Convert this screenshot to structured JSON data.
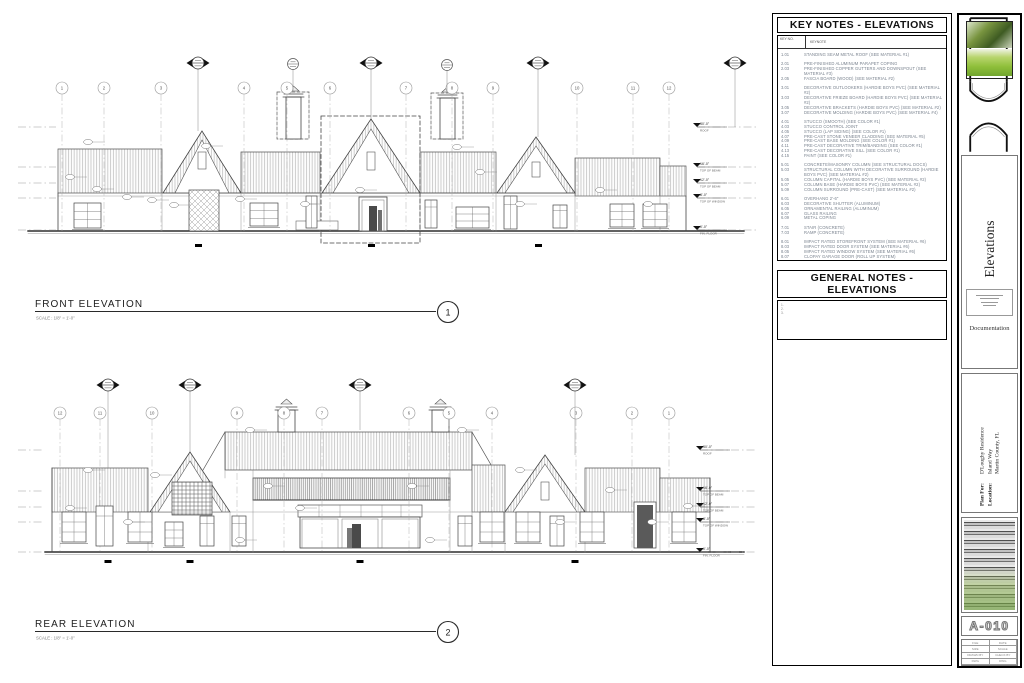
{
  "sheet": {
    "front": {
      "title": "FRONT ELEVATION",
      "number": "1",
      "scale": "SCALE :  1/8\" = 1'-0\""
    },
    "rear": {
      "title": "REAR ELEVATION",
      "number": "2",
      "scale": "SCALE :  1/8\" = 1'-0\""
    },
    "front_grid_labels": [
      "1",
      "2",
      "3",
      "4",
      "5",
      "6",
      "7",
      "8",
      "9",
      "10",
      "11",
      "12"
    ],
    "rear_grid_labels": [
      "12",
      "11",
      "10",
      "9",
      "8",
      "7",
      "6",
      "5",
      "4",
      "3",
      "2",
      "1"
    ],
    "levels": [
      {
        "value": "30'-0\"",
        "label": "ROOF"
      },
      {
        "value": "16'-0\"",
        "label": "TOP OF BEAM"
      },
      {
        "value": "12'-0\"",
        "label": "TOP OF BEAM"
      },
      {
        "value": "8'-0\"",
        "label": "TOP OF WINDOW"
      },
      {
        "value": "0'-0\"",
        "label": "FIN. FLOOR"
      }
    ]
  },
  "key_notes": {
    "title": "KEY NOTES - ELEVATIONS",
    "col_key": "KEY NO.",
    "col_note": "KEYNOTE",
    "items": [
      {
        "no": "1.01",
        "text": "STANDING SEAM METAL ROOF (SEE MATERIAL #1)"
      },
      {
        "no": "2.01",
        "text": "PRE-FINISHED ALUMINUM PARAPET COPING"
      },
      {
        "no": "2.03",
        "text": "PRE-FINISHED COPPER GUTTERS AND DOWNSPOUT (SEE MATERIAL #3)"
      },
      {
        "no": "2.05",
        "text": "FASCIA BOARD (WOOD) (SEE MATERIAL #2)"
      },
      {
        "no": "3.01",
        "text": "DECORATIVE OUTLOOKERS (HARDIE BOYS PVC) (SEE MATERIAL #2)"
      },
      {
        "no": "3.03",
        "text": "DECORATIVE FRIEZE BOARD (HARDIE BOYS PVC) (SEE MATERIAL #2)"
      },
      {
        "no": "3.05",
        "text": "DECORATIVE BRACKETS (HARDIE BOYS PVC) (SEE MATERIAL #2)"
      },
      {
        "no": "3.07",
        "text": "DECORATIVE MOLDING (HARDIE BOYS PVC) (SEE MATERIAL #4)"
      },
      {
        "no": "4.01",
        "text": "STUCCO (SMOOTH) (SEE COLOR #1)"
      },
      {
        "no": "4.03",
        "text": "STUCCO CONTROL JOINT"
      },
      {
        "no": "4.05",
        "text": "STUCCO (LAP SIDING) (SEE COLOR #1)"
      },
      {
        "no": "4.07",
        "text": "PRE-CAST STONE VENEER CLADDING (SEE MATERIAL #5)"
      },
      {
        "no": "4.09",
        "text": "PRE-CAST BASE MOLDING (SEE COLOR #1)"
      },
      {
        "no": "4.11",
        "text": "PRE-CAST DECORATIVE TRIM/BANDING (SEE COLOR #1)"
      },
      {
        "no": "4.13",
        "text": "PRE-CAST DECORATIVE SILL (SEE COLOR #1)"
      },
      {
        "no": "4.15",
        "text": "PAINT (SEE COLOR #1)"
      },
      {
        "no": "5.01",
        "text": "CONCRETE/MASONRY COLUMN (SEE STRUCTURAL DOCS)"
      },
      {
        "no": "5.03",
        "text": "STRUCTURAL COLUMN WITH DECORATIVE SURROUND (HARDIE BOYS PVC) (SEE MATERIAL #2)"
      },
      {
        "no": "5.05",
        "text": "COLUMN CAPITAL (HARDIE BOYS PVC) (SEE MATERIAL #2)"
      },
      {
        "no": "5.07",
        "text": "COLUMN BASE (HARDIE BOYS PVC) (SEE MATERIAL #2)"
      },
      {
        "no": "5.09",
        "text": "COLUMN SURROUND (PRE-CAST) (SEE MATERIAL #2)"
      },
      {
        "no": "6.01",
        "text": "OVERHANG 2'-6\""
      },
      {
        "no": "6.03",
        "text": "DECORATIVE SHUTTER (ALUMINUM)"
      },
      {
        "no": "6.05",
        "text": "ORNAMENTAL RAILING (ALUMINUM)"
      },
      {
        "no": "6.07",
        "text": "GLASS RAILING"
      },
      {
        "no": "6.09",
        "text": "METAL COPING"
      },
      {
        "no": "7.01",
        "text": "STAIR (CONCRETE)"
      },
      {
        "no": "7.03",
        "text": "RAMP (CONCRETE)"
      },
      {
        "no": "8.01",
        "text": "IMPACT RATED STOREFRONT SYSTEM (SEE MATERIAL #6)"
      },
      {
        "no": "8.03",
        "text": "IMPACT RATED DOOR SYSTEM (SEE MATERIAL #6)"
      },
      {
        "no": "8.05",
        "text": "IMPACT RATED WINDOW SYSTEM (SEE MATERIAL #6)"
      },
      {
        "no": "8.07",
        "text": "CLOPAY GARAGE DOOR (ROLL UP SYSTEM)"
      },
      {
        "no": "9.01",
        "text": "DECORATIVE EXTERIOR LIGHTING (REFER TO ELECT. DOCS)"
      },
      {
        "no": "10.01",
        "text": "LIGHTING FIXTURE"
      }
    ]
  },
  "general_notes": {
    "title": "GENERAL NOTES - ELEVATIONS",
    "items": [
      "1.",
      "2.",
      "3."
    ]
  },
  "titleblock": {
    "discipline": "Elevations",
    "phase": "Documentation",
    "plan_for_label": "Plan For:",
    "plan_for_value": "D'Loughy Residence",
    "location_label": "Location:",
    "location_value_1": "Island Way",
    "location_value_2": "Martin County, FL",
    "sheet_number": "A-010",
    "info_rows": [
      [
        "FILE",
        "DATE"
      ],
      [
        "SIZE",
        "SCALE"
      ],
      [
        "DRAWN BY",
        "CHECK BY"
      ],
      [
        "DWG",
        "DWG"
      ]
    ]
  }
}
